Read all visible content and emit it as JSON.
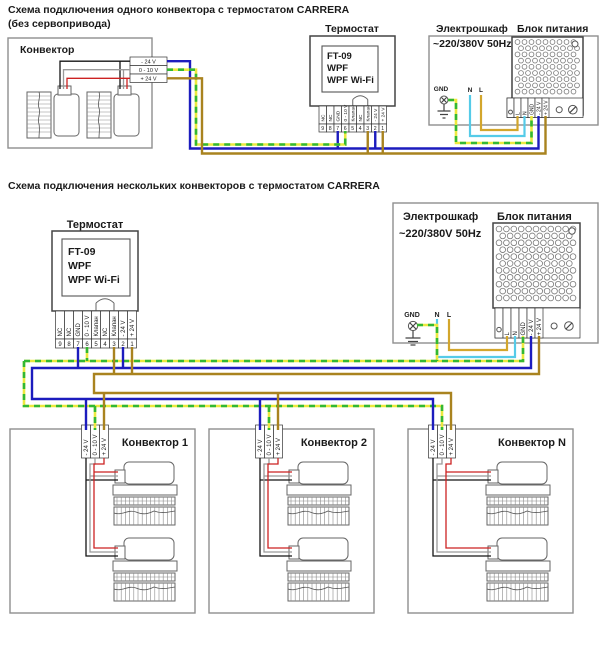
{
  "diagram1": {
    "title_line1": "Схема подключения одного конвектора с термостатом CARRERA",
    "title_line2": "(без сервопривода)",
    "convector": {
      "label": "Конвектор",
      "terminals": [
        "- 24 V",
        "0 - 10 V",
        "+ 24 V"
      ]
    },
    "thermostat": {
      "label": "Термостат",
      "model_lines": [
        "FT-09",
        "WPF",
        "WPF Wi-Fi"
      ],
      "terminal_labels": [
        "NC",
        "NC",
        "GND",
        "0 - 10 V",
        "Клапан",
        "NC",
        "Клапан",
        "- 24 V",
        "+ 24 V"
      ],
      "terminal_numbers": [
        "9",
        "8",
        "7",
        "6",
        "5",
        "4",
        "3",
        "2",
        "1"
      ]
    },
    "cabinet": {
      "label": "Электрошкаф",
      "voltage": "~220/380V 50Hz",
      "gnd": "GND",
      "n": "N",
      "l": "L"
    },
    "psu": {
      "label": "Блок питания",
      "terminals": [
        "L",
        "N",
        "GND",
        "- 24 V",
        "+ 24 V"
      ]
    }
  },
  "diagram2": {
    "title": "Схема подключения нескольких конвекторов с термостатом CARRERA",
    "thermostat": {
      "label": "Термостат",
      "model_lines": [
        "FT-09",
        "WPF",
        "WPF Wi-Fi"
      ],
      "terminal_labels": [
        "NC",
        "NC",
        "GND",
        "0 - 10 V",
        "Клапан",
        "NC",
        "Клапан",
        "- 24 V",
        "+ 24 V"
      ],
      "terminal_numbers": [
        "9",
        "8",
        "7",
        "6",
        "5",
        "4",
        "3",
        "2",
        "1"
      ]
    },
    "cabinet": {
      "label": "Электрошкаф",
      "voltage": "~220/380V 50Hz",
      "gnd": "GND",
      "n": "N",
      "l": "L"
    },
    "psu": {
      "label": "Блок питания",
      "terminals": [
        "L",
        "N",
        "GND",
        "- 24 V",
        "+ 24 V"
      ]
    },
    "convectors": [
      {
        "label": "Конвектор 1",
        "terminals": [
          "- 24 V",
          "0 - 10 V",
          "+ 24 V"
        ]
      },
      {
        "label": "Конвектор 2",
        "terminals": [
          "- 24 V",
          "0 - 10 V",
          "+ 24 V"
        ]
      },
      {
        "label": "Конвектор N",
        "terminals": [
          "- 24 V",
          "0 - 10 V",
          "+ 24 V"
        ]
      }
    ]
  },
  "wire_colors": {
    "minus_24v": "#1c1cbe",
    "plus_24v": "#a9831f",
    "control_dash_base": "#ece93f",
    "control_dash_green": "#33b833",
    "line_l": "#d3a62c",
    "neutral_n": "#55cbe8",
    "motor_black": "#151515",
    "motor_gray": "#9a9a9a",
    "motor_red": "#cc2222"
  }
}
